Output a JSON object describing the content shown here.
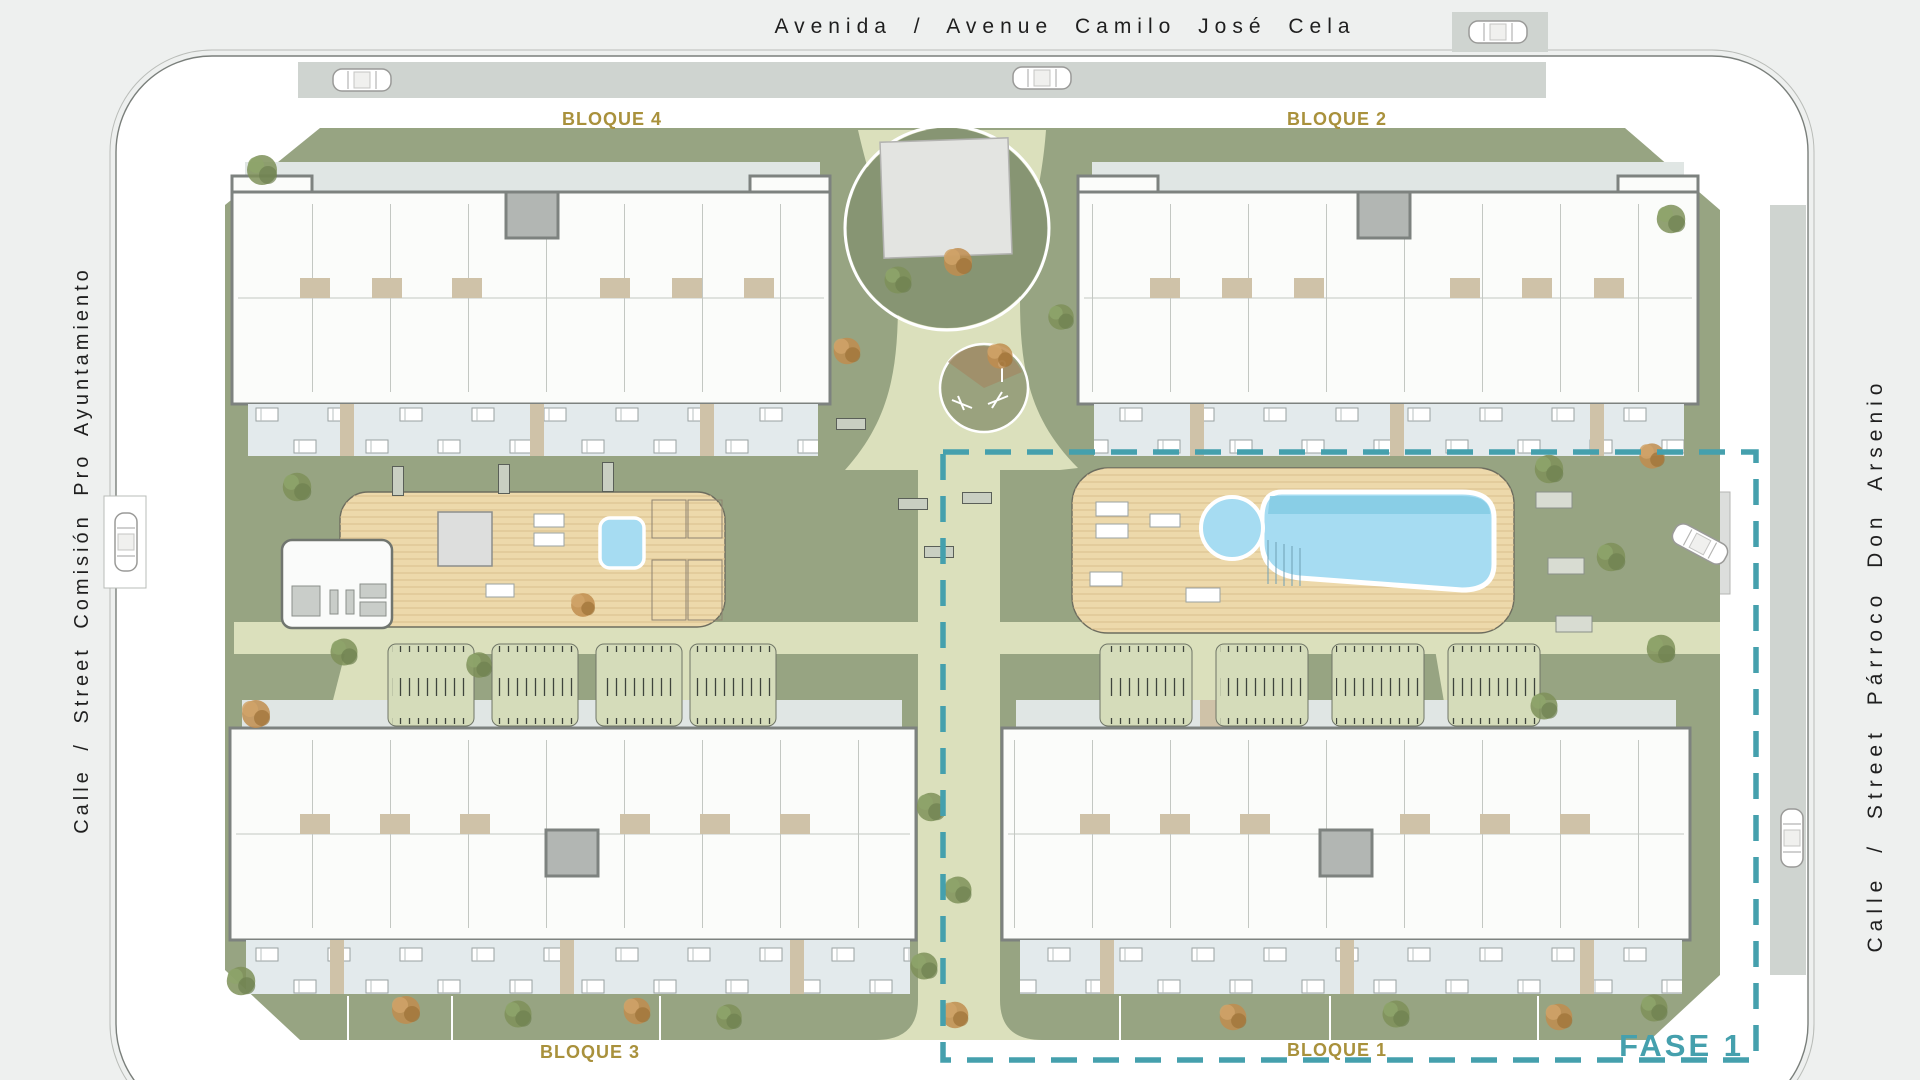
{
  "streets": {
    "top": "Avenida / Avenue Camilo José Cela",
    "left": "Calle / Street Comisión Pro Ayuntamiento",
    "right": "Calle / Street Párroco Don Arsenio"
  },
  "blocks": {
    "bloque1": "BLOQUE 1",
    "bloque2": "BLOQUE 2",
    "bloque3": "BLOQUE 3",
    "bloque4": "BLOQUE 4"
  },
  "phase": {
    "label": "FASE 1"
  },
  "colors": {
    "page-bg": "#eef0ef",
    "sidewalk": "#ffffff",
    "road": "#cfd4d0",
    "outline": "#7a7f7b",
    "lawn": "#97a482",
    "lawn-dark": "#879573",
    "path": "#dbe0bc",
    "deck": "#edd9ab",
    "deck-line": "#d9bf8c",
    "pool": "#a6dcf2",
    "pool-shade": "#84cbe4",
    "building": "#fbfcfa",
    "wall": "#7d827f",
    "walkway": "#e0e6e4",
    "terrace": "#e3eaec",
    "beige": "#cfc2a8",
    "core": "#b2b6b3",
    "pergola": "#d5dcba",
    "pergola-tick": "#3f443c",
    "tree-green": "#7e9159",
    "tree-orange": "#bf8d4f",
    "bench": "#c9cfc2",
    "gold": "#a9913c",
    "teal": "#45a0ad",
    "text-dark": "#1f1f1f"
  }
}
